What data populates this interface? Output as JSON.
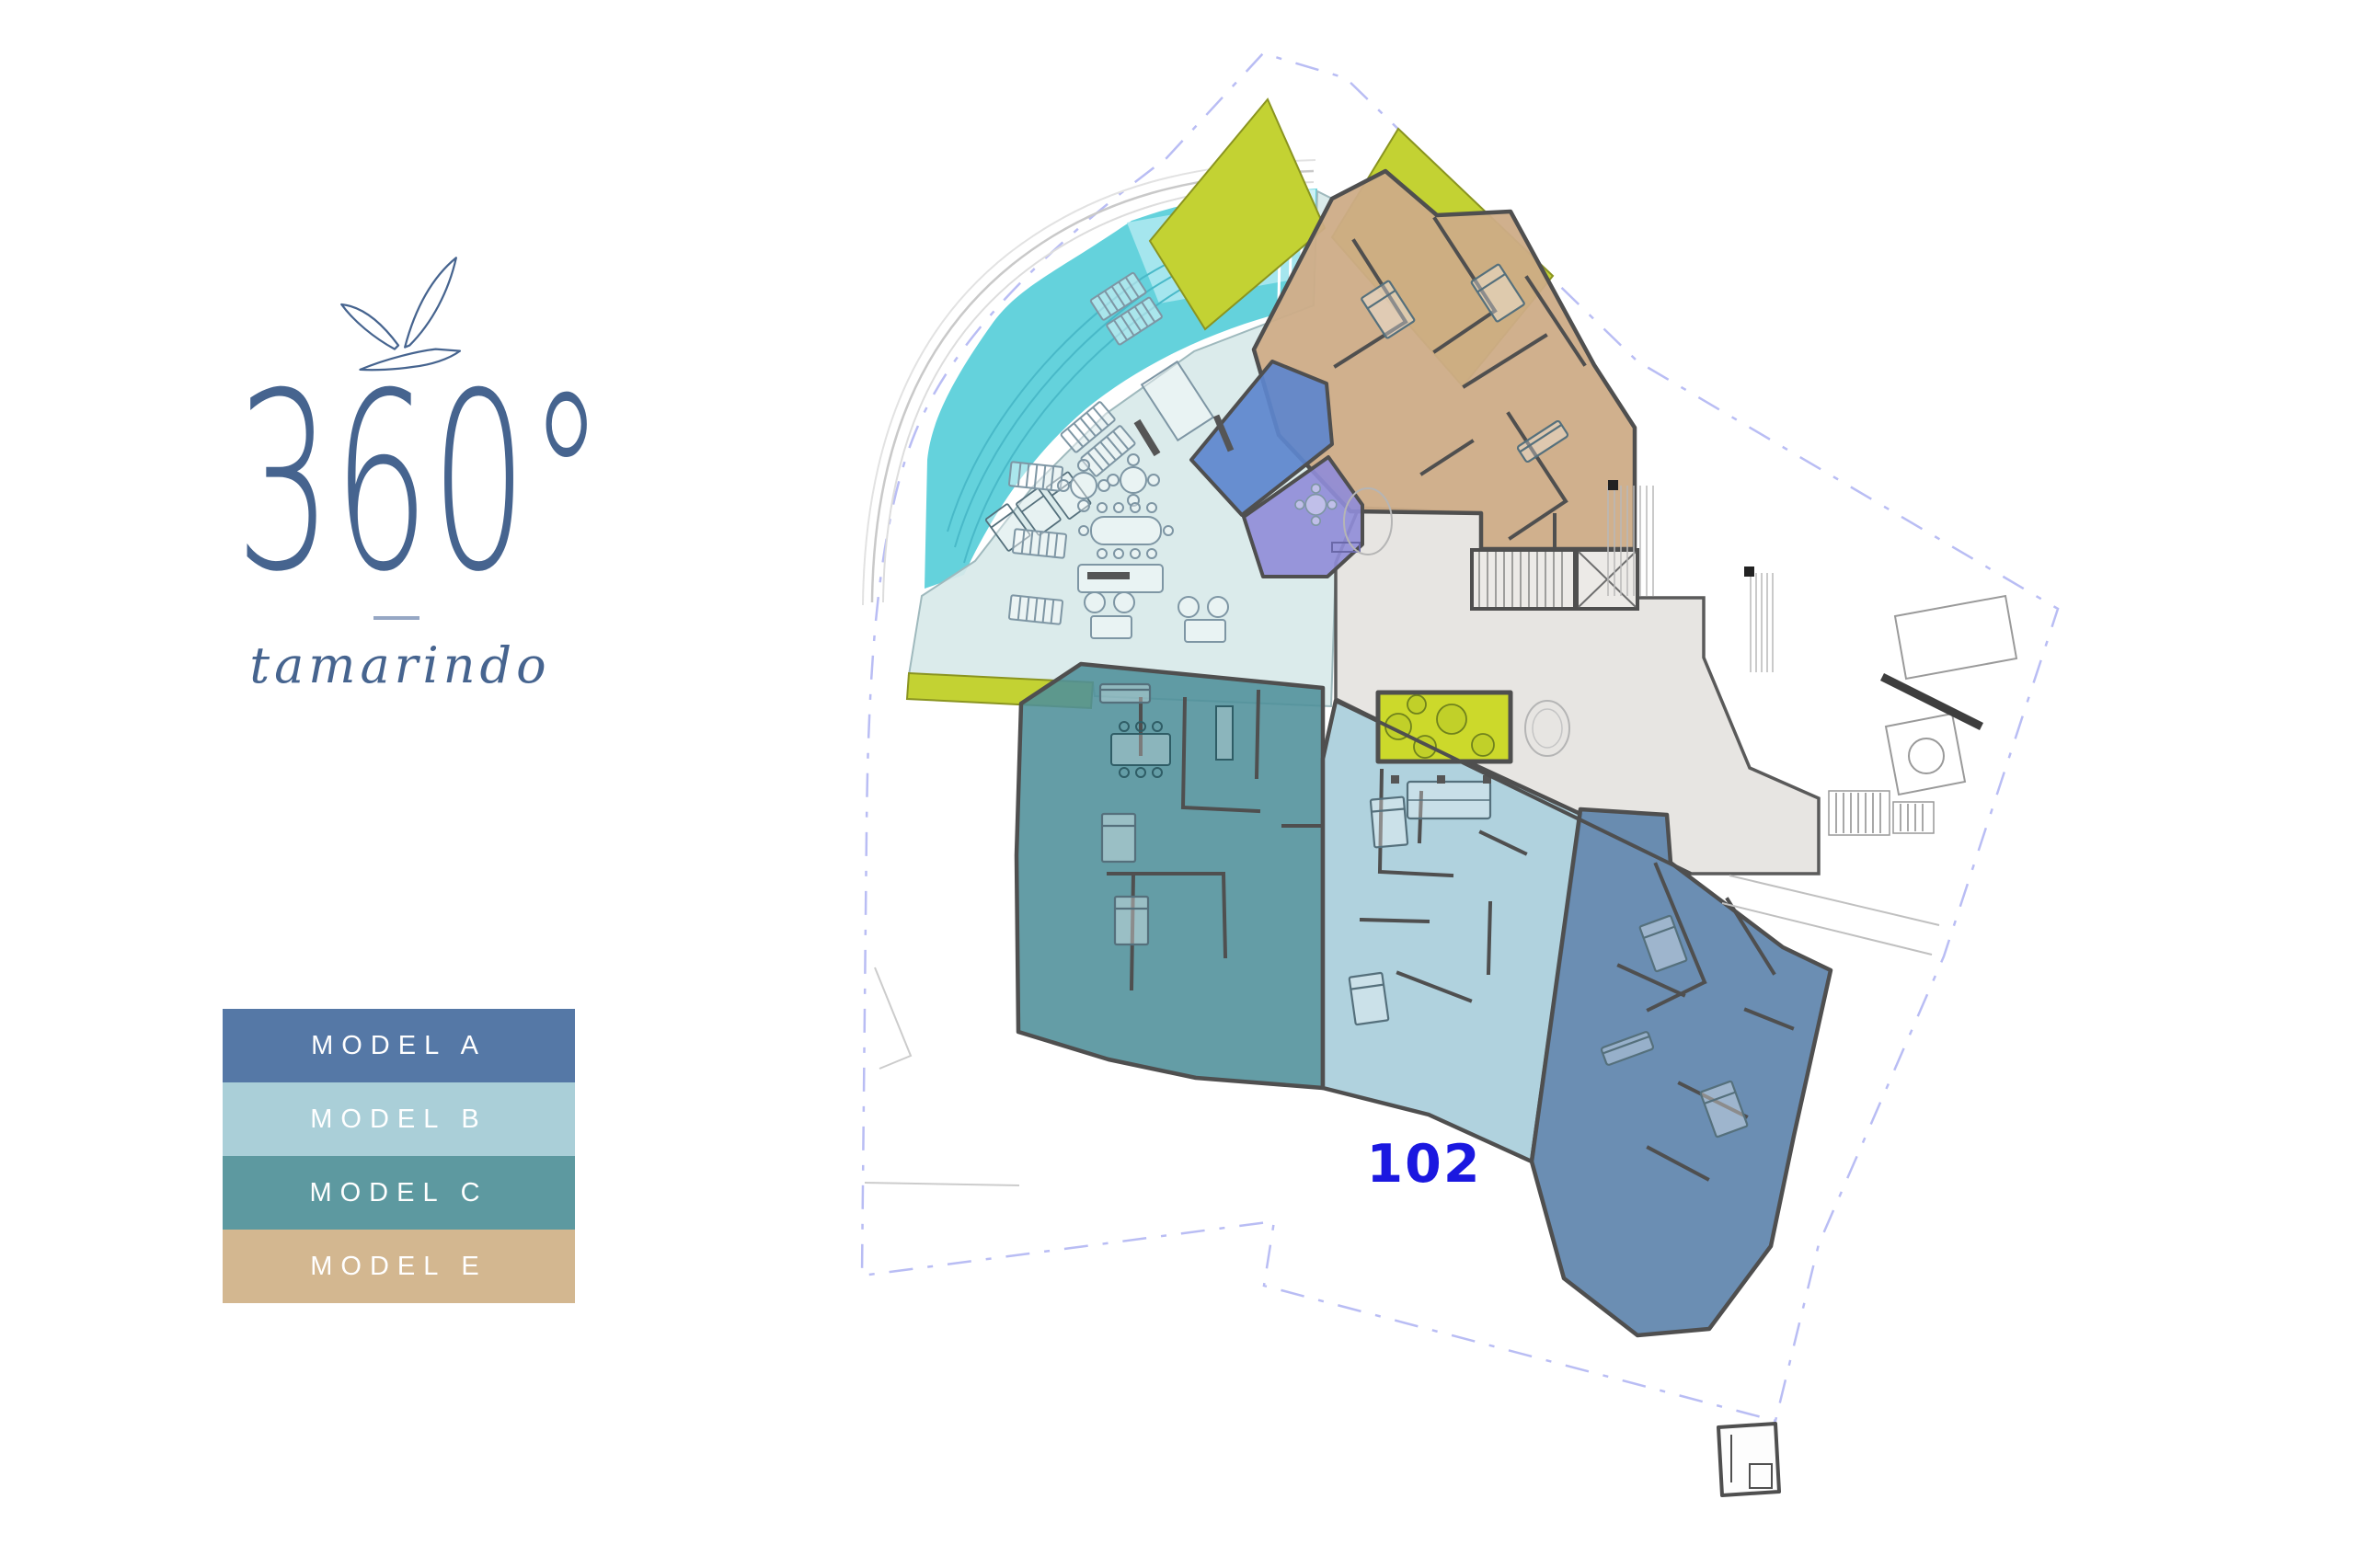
{
  "brand": {
    "degrees": "360°",
    "name": "tamarindo"
  },
  "legend": {
    "items": [
      {
        "label": "MODEL A",
        "color": "#5578a6"
      },
      {
        "label": "MODEL B",
        "color": "#aacfd8"
      },
      {
        "label": "MODEL C",
        "color": "#5d99a0"
      },
      {
        "label": "MODEL E",
        "color": "#d3b790"
      }
    ]
  },
  "plan": {
    "unit_label": {
      "text": "102",
      "color": "#1b18e0"
    },
    "colors": {
      "pool": "#64d2dc",
      "pool_light": "#a5e6ee",
      "pool_pale": "#cdf1f5",
      "deck": "#d8e9e9",
      "lobby": "#e7e5e2",
      "terrace_lime": "#c3d233",
      "courtyard_lime": "#ccd92b",
      "unit_a": "#5b82ab",
      "unit_b": "#a9cedb",
      "unit_c": "#4f8f9a",
      "unit_e": "#cdac87",
      "cabana_blue": "#5d86cd",
      "media_purple": "#8f8cd8",
      "walls": "#4f4f4f",
      "boundary": "#b9bdf4"
    }
  }
}
